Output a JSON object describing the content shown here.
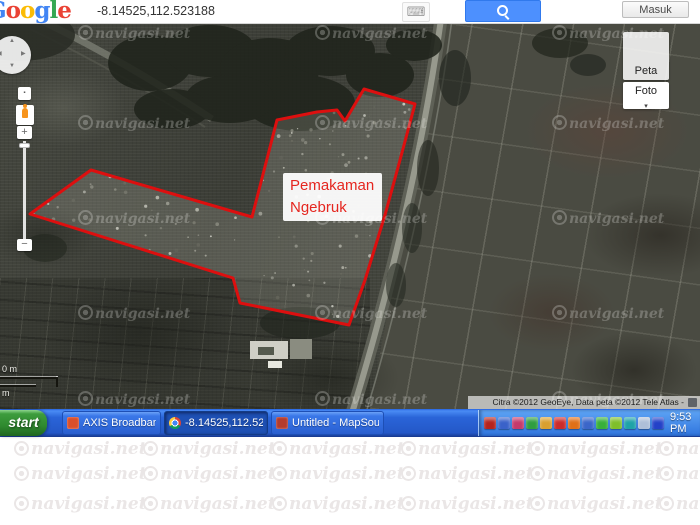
{
  "topbar": {
    "logo_letters": [
      {
        "ch": "G",
        "color": "#4285f4"
      },
      {
        "ch": "o",
        "color": "#ea4335"
      },
      {
        "ch": "o",
        "color": "#fbbc05"
      },
      {
        "ch": "g",
        "color": "#4285f4"
      },
      {
        "ch": "l",
        "color": "#34a853"
      },
      {
        "ch": "e",
        "color": "#ea4335"
      }
    ],
    "search_value": "-8.14525,112.523188",
    "keyboard_icon": "⌨",
    "signin_label": "Masuk"
  },
  "map": {
    "label": {
      "line1": "Pemakaman",
      "line2": "Ngebruk"
    },
    "polygon_points": "30,191 91,147 252,194 277,97 317,89 337,87 345,98 364,66 415,81 400,137 385,192 365,257 349,302 240,280 233,255",
    "polygon_color": "#dd0f0f",
    "buttons": {
      "peta": "Peta",
      "foto": "Foto",
      "foto_arrow": "▾"
    },
    "scale": {
      "top_label": "0 m",
      "bottom_label": "m"
    },
    "copyright": "Citra ©2012 GeoEye, Data peta ©2012 Tele Atlas -"
  },
  "taskbar": {
    "start_label": "start",
    "tasks": [
      {
        "name": "axis-broadband",
        "label": "AXIS Broadband 3G",
        "icon_color": "#d94f2b",
        "active": false,
        "left": 62,
        "width": 99
      },
      {
        "name": "chrome-coordinates",
        "label": "-8.14525,112.52318...",
        "icon_class": "chrome",
        "active": true,
        "left": 164,
        "width": 104
      },
      {
        "name": "mapsource",
        "label": "Untitled - MapSource",
        "icon_color": "#b33c2e",
        "active": false,
        "left": 271,
        "width": 113
      }
    ],
    "tray_icons": [
      {
        "name": "adobe-reader-icon",
        "color": "#b5231d"
      },
      {
        "name": "messenger-icon",
        "color": "#3a62c9"
      },
      {
        "name": "antivirus-icon",
        "color": "#c53a6b"
      },
      {
        "name": "status-green-icon",
        "color": "#2f9e3f"
      },
      {
        "name": "security-badge-icon",
        "color": "#d9a02f"
      },
      {
        "name": "red-user-icon",
        "color": "#cc2b2b"
      },
      {
        "name": "orange-swirl-icon",
        "color": "#e07018"
      },
      {
        "name": "display-settings-icon",
        "color": "#3b66c9"
      },
      {
        "name": "green-check-icon",
        "color": "#38b03a"
      },
      {
        "name": "leaf-icon",
        "color": "#7fbf2a"
      },
      {
        "name": "headset-icon",
        "color": "#1fa3a8"
      },
      {
        "name": "dual-monitor-icon",
        "color": "#aebfd8"
      },
      {
        "name": "network-icon",
        "color": "#2442c8"
      }
    ],
    "clock": "9:53 PM"
  },
  "watermark": {
    "text": "navigasi.net",
    "map_rows": [
      2,
      92,
      187,
      282,
      368
    ],
    "map_cols": [
      78,
      315,
      552
    ],
    "footer_rows": [
      2,
      27,
      57
    ],
    "footer_cols": [
      14,
      143,
      272,
      401,
      530,
      659
    ]
  }
}
